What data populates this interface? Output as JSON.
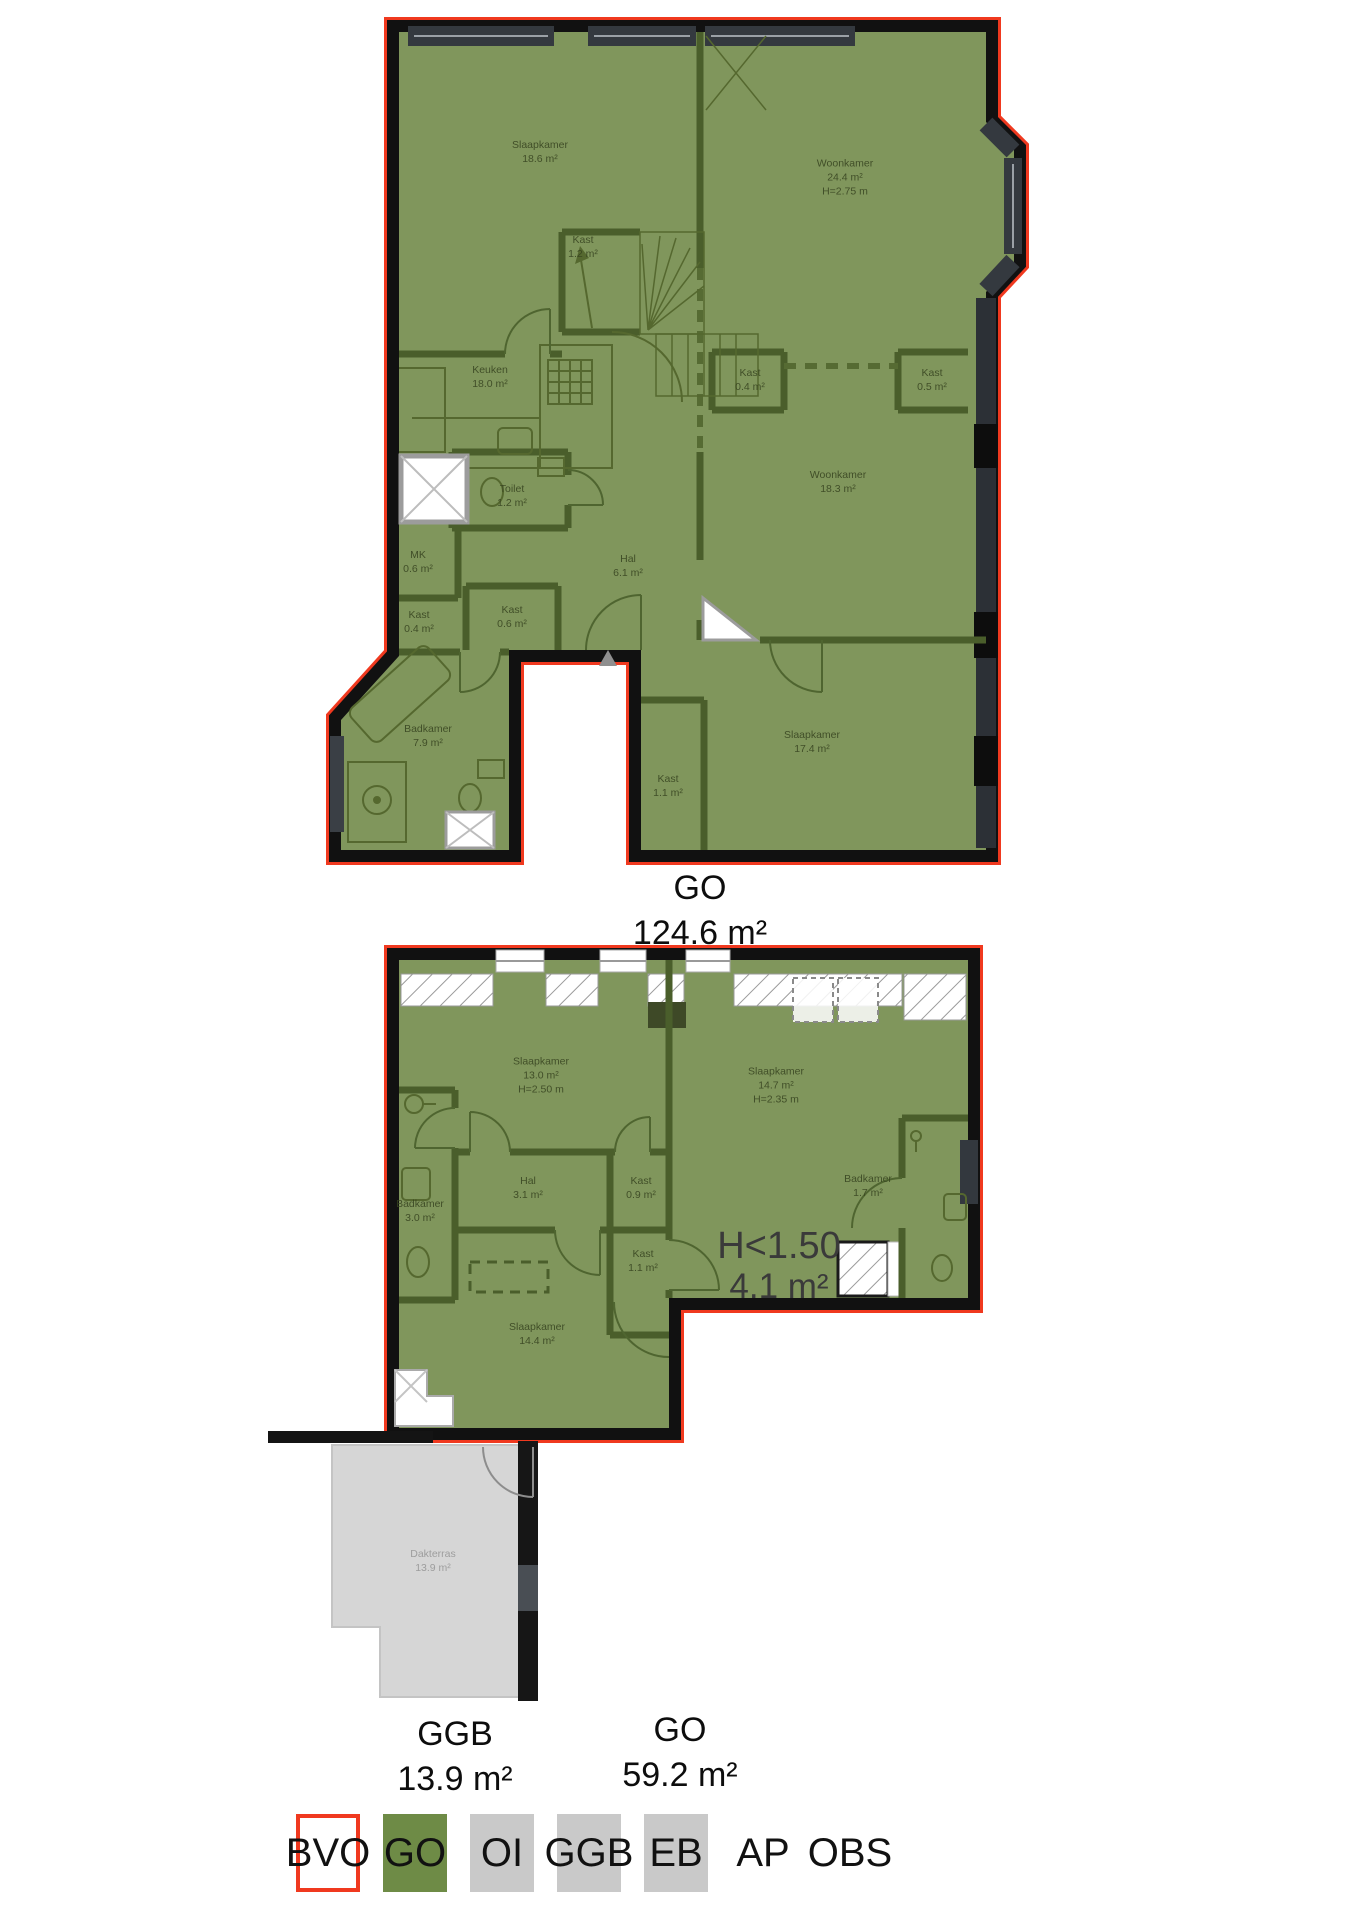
{
  "upper_plan": {
    "summary_code": "GO",
    "summary_area": "124.6 m²",
    "rooms": [
      {
        "name": "Slaapkamer",
        "area": "18.6 m²"
      },
      {
        "name": "Kast",
        "area": "1.2 m²"
      },
      {
        "name": "Woonkamer",
        "area": "24.4 m²",
        "height": "H=2.75 m"
      },
      {
        "name": "Keuken",
        "area": "18.0 m²"
      },
      {
        "name": "Kast",
        "area": "0.4 m²"
      },
      {
        "name": "Kast",
        "area": "0.5 m²"
      },
      {
        "name": "Woonkamer",
        "area": "18.3 m²"
      },
      {
        "name": "Toilet",
        "area": "1.2 m²"
      },
      {
        "name": "MK",
        "area": "0.6 m²"
      },
      {
        "name": "Kast",
        "area": "0.4 m²"
      },
      {
        "name": "Kast",
        "area": "0.6 m²"
      },
      {
        "name": "Hal",
        "area": "6.1 m²"
      },
      {
        "name": "Badkamer",
        "area": "7.9 m²"
      },
      {
        "name": "Kast",
        "area": "1.1 m²"
      },
      {
        "name": "Slaapkamer",
        "area": "17.4 m²"
      }
    ]
  },
  "lower_plan": {
    "summary_ggb_code": "GGB",
    "summary_ggb_area": "13.9 m²",
    "summary_go_code": "GO",
    "summary_go_area": "59.2 m²",
    "low_height_annotation": {
      "line1": "H<1.50",
      "line2": "4.1 m²"
    },
    "rooms": [
      {
        "name": "Slaapkamer",
        "area": "13.0 m²",
        "height": "H=2.50 m"
      },
      {
        "name": "Slaapkamer",
        "area": "14.7 m²",
        "height": "H=2.35 m"
      },
      {
        "name": "Badkamer",
        "area": "3.0 m²"
      },
      {
        "name": "Hal",
        "area": "3.1 m²"
      },
      {
        "name": "Kast",
        "area": "0.9 m²"
      },
      {
        "name": "Badkamer",
        "area": "1.7 m²"
      },
      {
        "name": "Kast",
        "area": "1.1 m²"
      },
      {
        "name": "Slaapkamer",
        "area": "14.4 m²"
      },
      {
        "name": "Dakterras",
        "area": "13.9 m²"
      }
    ]
  },
  "legend": {
    "items": [
      {
        "label": "BVO"
      },
      {
        "label": "GO"
      },
      {
        "label": "OI"
      },
      {
        "label": "GGB"
      },
      {
        "label": "EB"
      },
      {
        "label": "AP"
      },
      {
        "label": "OBS"
      }
    ]
  },
  "colors": {
    "go_fill": "#80965c",
    "wall_green": "#4a5e2b",
    "outline_red": "#f0391f",
    "wall_black": "#111111",
    "terrace_gray": "#d6d6d6",
    "legend_gray": "#c9c9c9",
    "legend_green": "#6e8b46"
  }
}
